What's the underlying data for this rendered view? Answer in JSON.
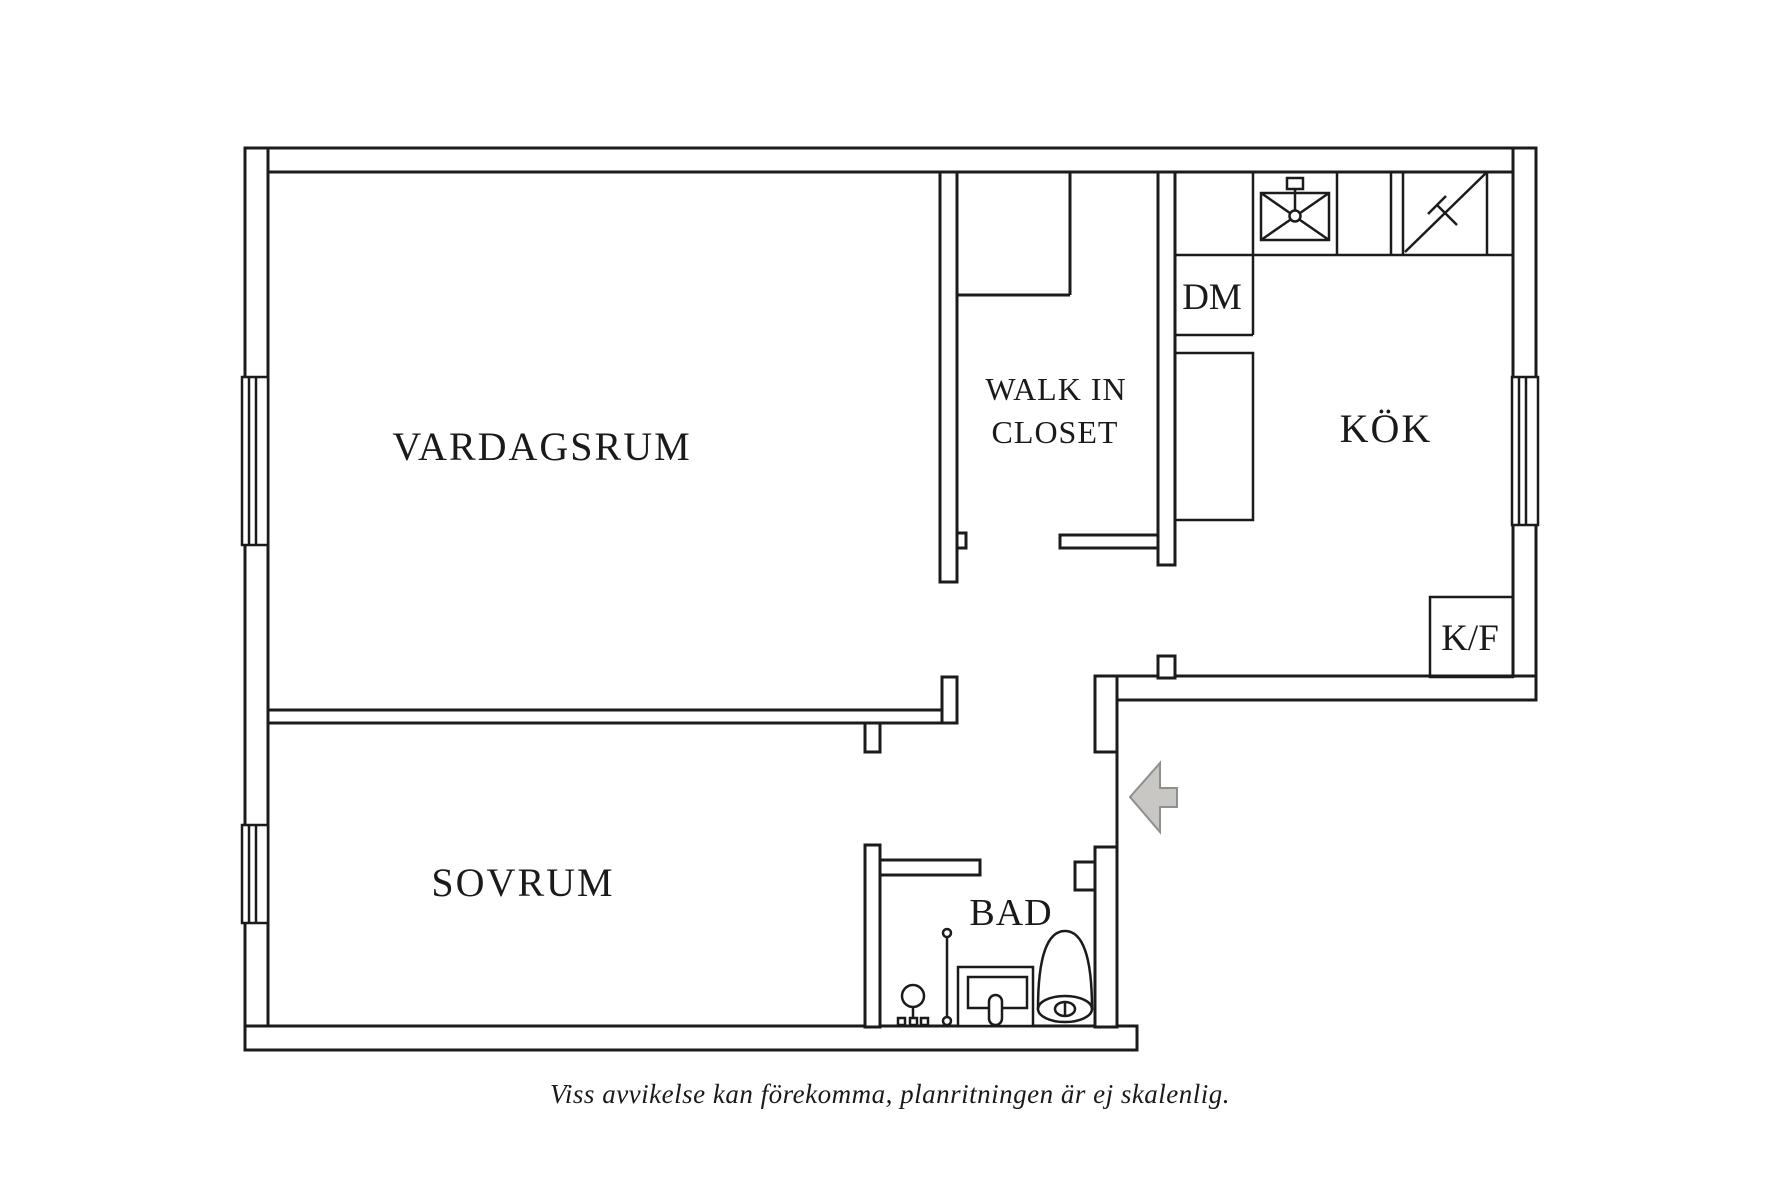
{
  "rooms": {
    "vardagsrum": "VARDAGSRUM",
    "sovrum": "SOVRUM",
    "kok": "KÖK",
    "walk_in_closet_line1": "WALK IN",
    "walk_in_closet_line2": "CLOSET",
    "bad": "BAD"
  },
  "appliances": {
    "dishwasher": "DM",
    "fridge_freezer": "K/F"
  },
  "caption": "Viss avvikelse kan förekomma, planritningen är ej skalenlig.",
  "icons": {
    "sink": "sink-icon",
    "stove": "stove-icon",
    "shower_mixer": "shower-mixer-icon",
    "shower_rail": "shower-rail-icon",
    "washbasin": "washbasin-icon",
    "toilet": "toilet-icon",
    "entrance_arrow": "entrance-arrow-icon",
    "window": "window-icon"
  },
  "colors": {
    "background": "#ffffff",
    "wall": "#1b1b1b",
    "text": "#1a1a1a",
    "arrow_fill": "#c8c7c4",
    "arrow_stroke": "#8e8e8c"
  }
}
